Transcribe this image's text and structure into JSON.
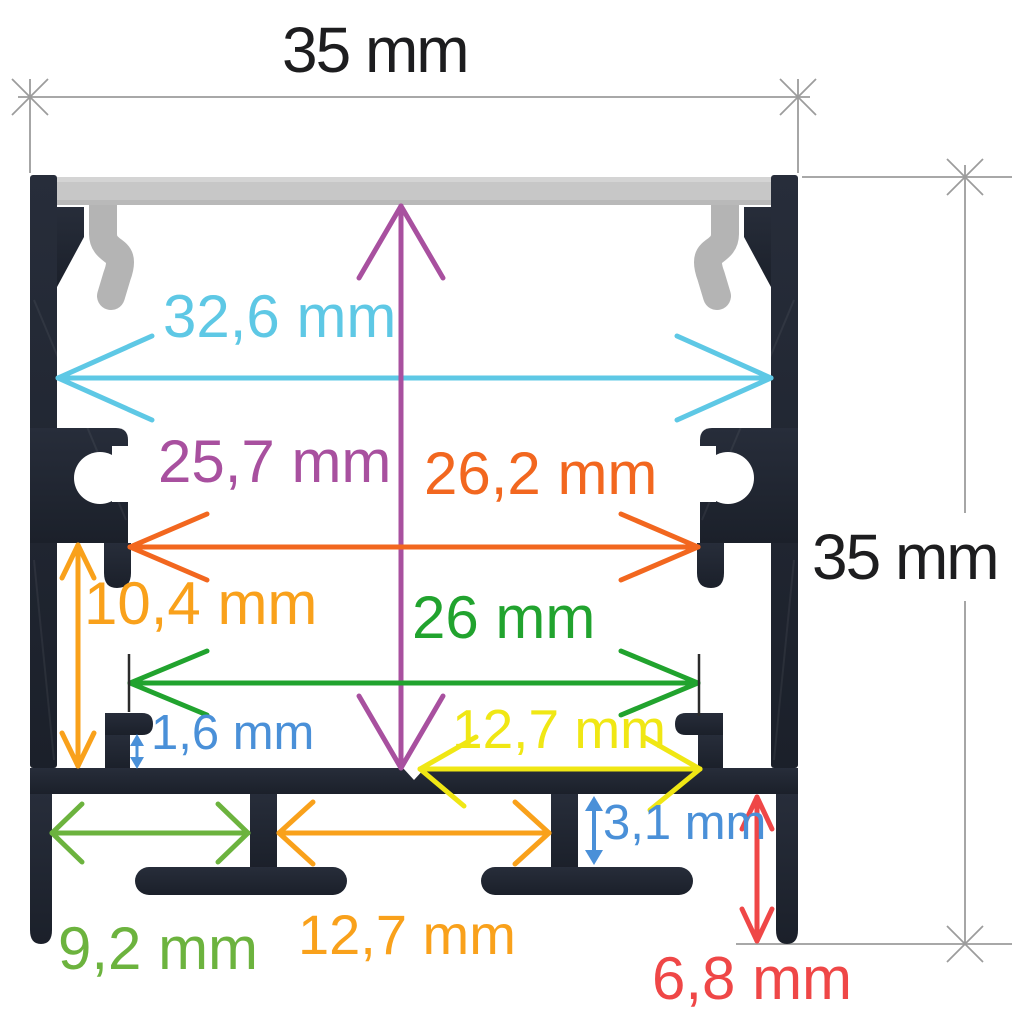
{
  "units": "mm",
  "diagram": {
    "kind": "profile-cross-section-dimension-drawing",
    "profile_color": "#212631",
    "diffuser_color": "#c7c7c7",
    "dimension_line_color": "#9c9c9c"
  },
  "dimensions": [
    {
      "id": "overall-width",
      "label": "35 mm",
      "value": 35,
      "orientation": "horizontal",
      "color": "#1d1d1f"
    },
    {
      "id": "overall-height",
      "label": "35 mm",
      "value": 35,
      "orientation": "vertical",
      "color": "#1d1d1f"
    },
    {
      "id": "inner-width-top",
      "label": "32,6 mm",
      "value": 32.6,
      "orientation": "horizontal",
      "color": "#5ec8e5"
    },
    {
      "id": "inner-height",
      "label": "25,7 mm",
      "value": 25.7,
      "orientation": "vertical",
      "color": "#a8509f"
    },
    {
      "id": "inner-width-mid",
      "label": "26,2 mm",
      "value": 26.2,
      "orientation": "horizontal",
      "color": "#f2671f"
    },
    {
      "id": "lower-chamber-height",
      "label": "10,4 mm",
      "value": 10.4,
      "orientation": "vertical",
      "color": "#f9a11b"
    },
    {
      "id": "ledge-span-width",
      "label": "26 mm",
      "value": 26,
      "orientation": "horizontal",
      "color": "#21a32e"
    },
    {
      "id": "ledge-lip-height",
      "label": "1,6 mm",
      "value": 1.6,
      "orientation": "vertical",
      "color": "#4a90d8"
    },
    {
      "id": "center-to-ledge-width",
      "label": "12,7 mm",
      "value": 12.7,
      "orientation": "horizontal",
      "color": "#f0e714"
    },
    {
      "id": "foot-web-height",
      "label": "3,1 mm",
      "value": 3.1,
      "orientation": "vertical",
      "color": "#4a90d8"
    },
    {
      "id": "foot-gap-outer-width",
      "label": "9,2 mm",
      "value": 9.2,
      "orientation": "horizontal",
      "color": "#6cb33e"
    },
    {
      "id": "foot-gap-center-width",
      "label": "12,7 mm",
      "value": 12.7,
      "orientation": "horizontal",
      "color": "#f9a11b"
    },
    {
      "id": "foot-height",
      "label": "6,8 mm",
      "value": 6.8,
      "orientation": "vertical",
      "color": "#ef4747"
    }
  ]
}
